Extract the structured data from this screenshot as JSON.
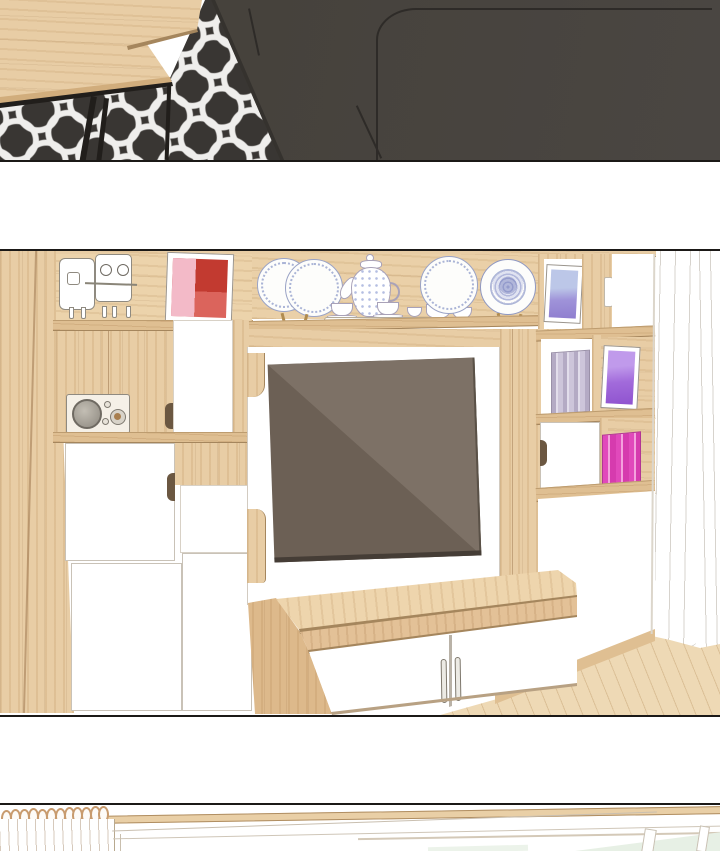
{
  "image_type": "webtoon interior illustration, no text",
  "panels": [
    {
      "id": "panel-1",
      "label": "living room corner with wooden coffee table, patterned rug and charcoal sofa",
      "objects": [
        "wooden coffee table top",
        "wooden side bench",
        "black metal table frame and legs",
        "dark rug with white interlocking ring pattern",
        "charcoal fabric sofa with seat seams"
      ]
    },
    {
      "id": "panel-2",
      "label": "light-wood TV wall unit with shelves, white cabinet doors and decor",
      "objects": [
        "white mini cabinet",
        "robot figurine with stick mouth",
        "red abstract framed art",
        "pair of china display plates",
        "porcelain teapot",
        "tea cups on tray",
        "white-rim decorative plate",
        "blue ornate plate on stand",
        "retro radio with round speaker",
        "wall-mounted flat screen TV with diagonal reflection",
        "TV console with wood top",
        "white console doors with two curved metal handles",
        "leaning frame with blue art",
        "leaning frame with purple art",
        "stack of lavender books",
        "stack of magenta books",
        "cabinet doors with finger cutout handles",
        "sheer white curtain",
        "light wood plank floor"
      ]
    },
    {
      "id": "panel-3",
      "label": "wooden curtain rod with rings above a window with pale green glass",
      "objects": [
        "wooden curtain rod",
        "twelve wooden curtain rings",
        "white curtain folds",
        "window sill lines",
        "window frame with pale green glass"
      ]
    }
  ],
  "palette": {
    "ink": "#1b1917",
    "wood": "#e8cda5",
    "wood2": "#dfbf92",
    "wood3": "#d1ad7c",
    "wood_line": "#a5865d",
    "floor": "#eed9b5",
    "panel_line": "#c9c2b7",
    "outline_gray": "#8f8a80",
    "sofa": "#474340",
    "sofa_line": "#2e2b28",
    "rug": "#393633",
    "rug_pat": "#efeeec",
    "metal": "#211e1b",
    "tv": "#6c6055",
    "tv_glare": "#7d7166",
    "tv_bezel": "#453d36",
    "art_pink": "#f3bac8",
    "art_red": "#c23a30",
    "art_red2": "#db645c",
    "art_blue1": "#bcc7e8",
    "art_blue2": "#8f7ecf",
    "art_purple1": "#c09aeb",
    "art_purple2": "#8f53cf",
    "books_gray1": "#b4aac4",
    "books_gray2": "#e2ddeb",
    "books_pink1": "#e149bb",
    "books_pink2": "#f4a2dd",
    "plate_line": "#9aa3c6",
    "china": "#aab4d6",
    "curtain_line": "#d7d3cd",
    "glass": "#e7f0e5",
    "radio_body": "#f5f0e7",
    "knob_brown": "#a87e4e",
    "ring": "#c89b6e"
  }
}
